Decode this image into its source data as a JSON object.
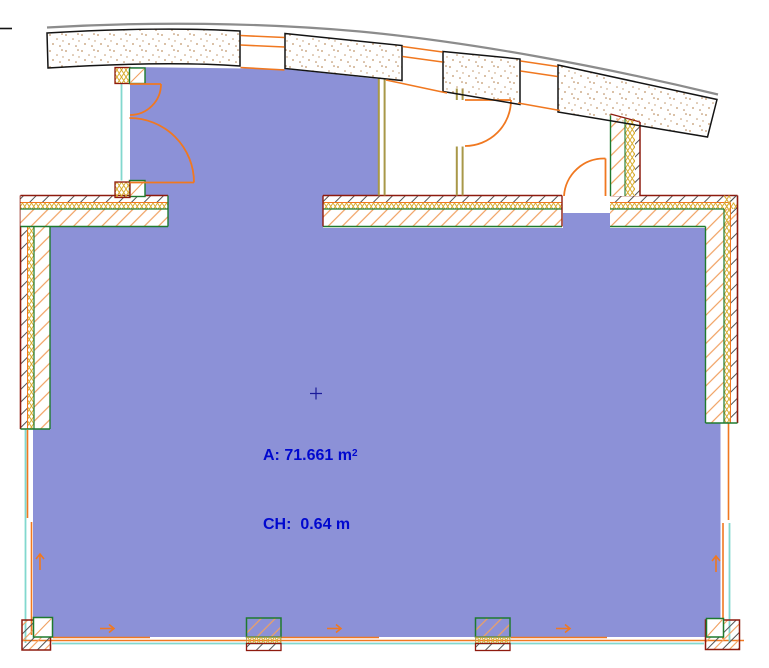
{
  "zone_stamp": {
    "area_prefix": "A: 71.661 m",
    "area_exponent": "2",
    "ceiling_height": "CH:  0.64 m"
  },
  "colors": {
    "zone_fill": "#8C91D7",
    "zone_text": "#0008CF",
    "door_orange": "#F07820",
    "hatch_orange": "#F0A060",
    "wall_dark_red": "#8E1A0E",
    "wall_green": "#1E7A2E",
    "partition_olive": "#A89848",
    "insulation_yellow": "#D8AC30",
    "window_cyan": "#82D8CE",
    "facade_gray": "#8C8C8C",
    "outline_black": "#141414",
    "stipple_dot": "#C09468",
    "hatch_dark": "#555555"
  }
}
